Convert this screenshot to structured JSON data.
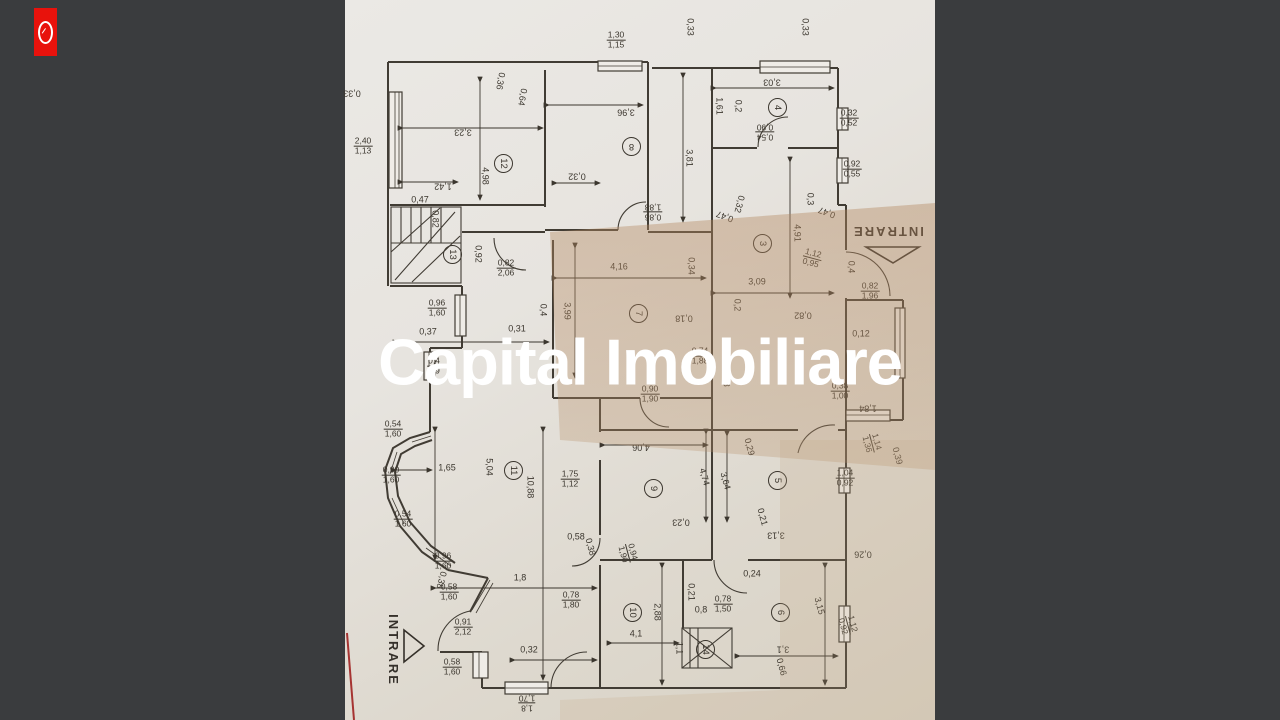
{
  "background": {
    "color": "#3a3c3e"
  },
  "watermark": {
    "text": "Capital Imobiliare",
    "color": "#ffffff"
  },
  "logo": {
    "label": "capital-imobiliare-logo",
    "color": "#e8120c"
  },
  "floorplan": {
    "rooms": [
      {
        "n": "12",
        "x": 503,
        "y": 163,
        "r": 90
      },
      {
        "n": "8",
        "x": 631,
        "y": 146,
        "r": 180
      },
      {
        "n": "4",
        "x": 777,
        "y": 107,
        "r": 90
      },
      {
        "n": "13",
        "x": 452,
        "y": 254,
        "r": 90
      },
      {
        "n": "3",
        "x": 762,
        "y": 243,
        "r": 90
      },
      {
        "n": "7",
        "x": 638,
        "y": 313,
        "r": 90
      },
      {
        "n": "11",
        "x": 513,
        "y": 470,
        "r": 90
      },
      {
        "n": "9",
        "x": 653,
        "y": 488,
        "r": 90
      },
      {
        "n": "5",
        "x": 777,
        "y": 480,
        "r": 90
      },
      {
        "n": "10",
        "x": 632,
        "y": 612,
        "r": 90
      },
      {
        "n": "14",
        "x": 705,
        "y": 649,
        "r": 90
      },
      {
        "n": "6",
        "x": 780,
        "y": 612,
        "r": 90
      }
    ],
    "dimensions": [
      {
        "t": "0,33",
        "x": 352,
        "y": 93,
        "r": 180
      },
      {
        "t": "2,40/1,13",
        "x": 363,
        "y": 146,
        "r": 0
      },
      {
        "t": "0,33",
        "x": 690,
        "y": 27,
        "r": 90
      },
      {
        "t": "1,30/1,15",
        "x": 616,
        "y": 40,
        "r": 0
      },
      {
        "t": "0,33",
        "x": 805,
        "y": 27,
        "r": 90
      },
      {
        "t": "0,36",
        "x": 500,
        "y": 81,
        "r": 100
      },
      {
        "t": "0,64",
        "x": 522,
        "y": 97,
        "r": 100
      },
      {
        "t": "3,23",
        "x": 463,
        "y": 132,
        "r": 180
      },
      {
        "t": "3,96",
        "x": 626,
        "y": 112,
        "r": 180
      },
      {
        "t": "3,03",
        "x": 772,
        "y": 82,
        "r": 180
      },
      {
        "t": "1,61",
        "x": 719,
        "y": 106,
        "r": 90
      },
      {
        "t": "0,2",
        "x": 738,
        "y": 106,
        "r": 90
      },
      {
        "t": "0,54/0,90",
        "x": 765,
        "y": 132,
        "r": 180
      },
      {
        "t": "0,32/0,52",
        "x": 849,
        "y": 118,
        "r": 0
      },
      {
        "t": "3,81",
        "x": 689,
        "y": 158,
        "r": 90
      },
      {
        "t": "4,98",
        "x": 485,
        "y": 176,
        "r": 90
      },
      {
        "t": "1,42",
        "x": 443,
        "y": 186,
        "r": 180
      },
      {
        "t": "0,47",
        "x": 420,
        "y": 200,
        "r": 0
      },
      {
        "t": "0,82",
        "x": 435,
        "y": 219,
        "r": 90
      },
      {
        "t": "0,32",
        "x": 577,
        "y": 176,
        "r": 180
      },
      {
        "t": "0,92/0,55",
        "x": 852,
        "y": 169,
        "r": 0
      },
      {
        "t": "0,86/1,88",
        "x": 653,
        "y": 212,
        "r": 180
      },
      {
        "t": "0,47",
        "x": 725,
        "y": 216,
        "r": 200
      },
      {
        "t": "0,32",
        "x": 739,
        "y": 204,
        "r": 105
      },
      {
        "t": "0,3",
        "x": 810,
        "y": 199,
        "r": 90
      },
      {
        "t": "0,47",
        "x": 827,
        "y": 212,
        "r": 200
      },
      {
        "t": "INTRARE",
        "x": 888,
        "y": 231,
        "r": 180,
        "fs": 13,
        "name": "entrance-label-top"
      },
      {
        "t": "0,4",
        "x": 851,
        "y": 267,
        "r": 90
      },
      {
        "t": "0,82/1,96",
        "x": 870,
        "y": 291,
        "r": 0
      },
      {
        "t": "0,12",
        "x": 861,
        "y": 334,
        "r": 0
      },
      {
        "t": "0,92",
        "x": 478,
        "y": 254,
        "r": 90
      },
      {
        "t": "0,82/2,06",
        "x": 506,
        "y": 268,
        "r": 0
      },
      {
        "t": "4,16",
        "x": 619,
        "y": 267,
        "r": 0
      },
      {
        "t": "0,34",
        "x": 691,
        "y": 266,
        "r": 90
      },
      {
        "t": "4,91",
        "x": 797,
        "y": 233,
        "r": 90
      },
      {
        "t": "1,12/0,95",
        "x": 812,
        "y": 258,
        "r": 15
      },
      {
        "t": "3,09",
        "x": 757,
        "y": 282,
        "r": 0
      },
      {
        "t": "0,96/1,60",
        "x": 437,
        "y": 308,
        "r": 0
      },
      {
        "t": "0,4",
        "x": 543,
        "y": 310,
        "r": 90
      },
      {
        "t": "3,99",
        "x": 567,
        "y": 311,
        "r": 90
      },
      {
        "t": "0,2",
        "x": 737,
        "y": 305,
        "r": 90
      },
      {
        "t": "0,18",
        "x": 684,
        "y": 318,
        "r": 180
      },
      {
        "t": "0,82",
        "x": 803,
        "y": 315,
        "r": 180
      },
      {
        "t": "0,37",
        "x": 428,
        "y": 332,
        "r": 0
      },
      {
        "t": "0,31",
        "x": 517,
        "y": 329,
        "r": 0
      },
      {
        "t": "0,4/1,9",
        "x": 434,
        "y": 366,
        "r": 0
      },
      {
        "t": "0,74/1,88",
        "x": 700,
        "y": 356,
        "r": 0
      },
      {
        "t": "1,98",
        "x": 726,
        "y": 378,
        "r": 90
      },
      {
        "t": "0,90/1,90",
        "x": 650,
        "y": 394,
        "r": 0
      },
      {
        "t": "0,38/1,00",
        "x": 840,
        "y": 391,
        "r": 0
      },
      {
        "t": "1,84",
        "x": 868,
        "y": 408,
        "r": 180
      },
      {
        "t": "0,54/1,60",
        "x": 393,
        "y": 429,
        "r": 0
      },
      {
        "t": "1,14/1,36",
        "x": 872,
        "y": 443,
        "r": 75
      },
      {
        "t": "0,39",
        "x": 897,
        "y": 456,
        "r": 75
      },
      {
        "t": "4,06",
        "x": 641,
        "y": 447,
        "r": 180
      },
      {
        "t": "0,29",
        "x": 749,
        "y": 447,
        "r": 75
      },
      {
        "t": "0,90/1,60",
        "x": 391,
        "y": 475,
        "r": 0
      },
      {
        "t": "1,65",
        "x": 447,
        "y": 468,
        "r": 0
      },
      {
        "t": "5,04",
        "x": 489,
        "y": 467,
        "r": 90
      },
      {
        "t": "10,88",
        "x": 530,
        "y": 487,
        "r": 90
      },
      {
        "t": "1,75/1,12",
        "x": 570,
        "y": 479,
        "r": 0
      },
      {
        "t": "4,74",
        "x": 704,
        "y": 477,
        "r": 75
      },
      {
        "t": "3,64",
        "x": 725,
        "y": 481,
        "r": 75
      },
      {
        "t": "1,04/0,92",
        "x": 845,
        "y": 478,
        "r": 0
      },
      {
        "t": "0,54/1,60",
        "x": 403,
        "y": 519,
        "r": 0
      },
      {
        "t": "0,23",
        "x": 681,
        "y": 522,
        "r": 180
      },
      {
        "t": "0,21",
        "x": 762,
        "y": 517,
        "r": 75
      },
      {
        "t": "3,13",
        "x": 776,
        "y": 535,
        "r": 180
      },
      {
        "t": "0,58",
        "x": 576,
        "y": 537,
        "r": 0
      },
      {
        "t": "0,38",
        "x": 590,
        "y": 547,
        "r": 75
      },
      {
        "t": "0,94/1,90",
        "x": 628,
        "y": 553,
        "r": 75
      },
      {
        "t": "0,26",
        "x": 863,
        "y": 554,
        "r": 180
      },
      {
        "t": "0,96/1,60",
        "x": 443,
        "y": 561,
        "r": 0
      },
      {
        "t": "0,38",
        "x": 441,
        "y": 580,
        "r": 105
      },
      {
        "t": "1,8",
        "x": 520,
        "y": 578,
        "r": 0
      },
      {
        "t": "0,58/1,60",
        "x": 449,
        "y": 592,
        "r": 0
      },
      {
        "t": "0,78/1,80",
        "x": 571,
        "y": 600,
        "r": 0
      },
      {
        "t": "0,78/1,50",
        "x": 723,
        "y": 604,
        "r": 0
      },
      {
        "t": "0,21",
        "x": 691,
        "y": 592,
        "r": 90
      },
      {
        "t": "0,8",
        "x": 701,
        "y": 610,
        "r": 0
      },
      {
        "t": "0,24",
        "x": 752,
        "y": 574,
        "r": 0
      },
      {
        "t": "2,88",
        "x": 657,
        "y": 612,
        "r": 90
      },
      {
        "t": "3,15",
        "x": 819,
        "y": 606,
        "r": 75
      },
      {
        "t": "1,12/0,92",
        "x": 848,
        "y": 625,
        "r": 75
      },
      {
        "t": "INTRARE",
        "x": 393,
        "y": 650,
        "r": 90,
        "fs": 13,
        "name": "entrance-label-bottom"
      },
      {
        "t": "0,91/2,12",
        "x": 463,
        "y": 627,
        "r": 0
      },
      {
        "t": "4,1",
        "x": 636,
        "y": 634,
        "r": 0
      },
      {
        "t": "1,1",
        "x": 679,
        "y": 648,
        "r": 90
      },
      {
        "t": "3,1",
        "x": 783,
        "y": 649,
        "r": 180
      },
      {
        "t": "0,32",
        "x": 529,
        "y": 650,
        "r": 0
      },
      {
        "t": "0,66",
        "x": 781,
        "y": 667,
        "r": 75
      },
      {
        "t": "0,58/1,60",
        "x": 452,
        "y": 667,
        "r": 0
      },
      {
        "t": "1,8/1,70",
        "x": 527,
        "y": 703,
        "r": 180
      }
    ]
  }
}
